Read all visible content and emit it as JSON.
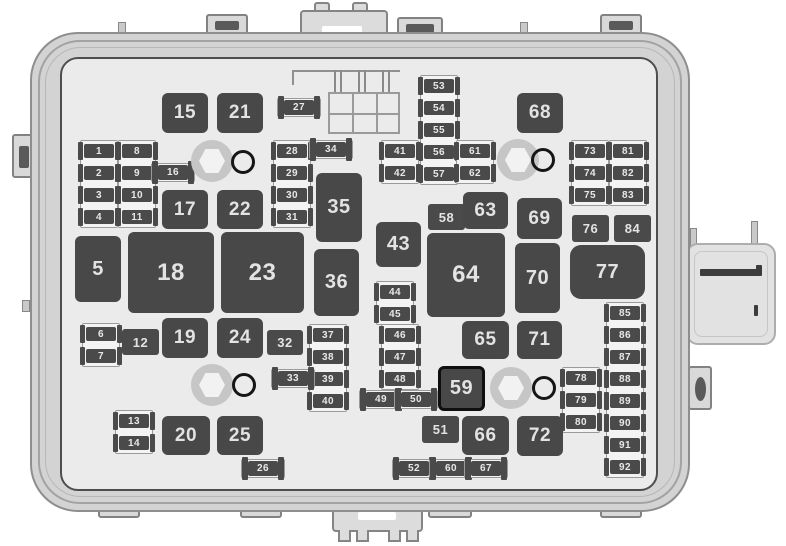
{
  "diagram": {
    "type": "fuse-box",
    "description": "Engine compartment fuse block diagram with numbered fuses and relays 1-92",
    "colors": {
      "case": "#d3d3d3",
      "panel": "#ebebeb",
      "relay_fill": "#484848",
      "fuse_fill": "#4a4a4a",
      "number_color": "#e3e3e3",
      "outline": "#4e4e4e"
    },
    "relays": [
      {
        "label": "5",
        "x": 75,
        "y": 236,
        "w": 46,
        "h": 66,
        "fs": 20
      },
      {
        "label": "15",
        "x": 162,
        "y": 93,
        "w": 46,
        "h": 40,
        "fs": 19
      },
      {
        "label": "21",
        "x": 217,
        "y": 93,
        "w": 46,
        "h": 40,
        "fs": 19
      },
      {
        "label": "17",
        "x": 162,
        "y": 190,
        "w": 46,
        "h": 39,
        "fs": 19
      },
      {
        "label": "22",
        "x": 217,
        "y": 190,
        "w": 46,
        "h": 39,
        "fs": 19
      },
      {
        "label": "18",
        "x": 128,
        "y": 232,
        "w": 86,
        "h": 81,
        "fs": 24
      },
      {
        "label": "23",
        "x": 221,
        "y": 232,
        "w": 83,
        "h": 81,
        "fs": 24
      },
      {
        "label": "19",
        "x": 162,
        "y": 318,
        "w": 46,
        "h": 40,
        "fs": 19
      },
      {
        "label": "24",
        "x": 217,
        "y": 318,
        "w": 46,
        "h": 40,
        "fs": 19
      },
      {
        "label": "20",
        "x": 162,
        "y": 416,
        "w": 48,
        "h": 39,
        "fs": 19
      },
      {
        "label": "25",
        "x": 217,
        "y": 416,
        "w": 46,
        "h": 39,
        "fs": 19
      },
      {
        "label": "35",
        "x": 316,
        "y": 173,
        "w": 46,
        "h": 69,
        "fs": 20
      },
      {
        "label": "36",
        "x": 314,
        "y": 249,
        "w": 45,
        "h": 67,
        "fs": 20
      },
      {
        "label": "43",
        "x": 376,
        "y": 222,
        "w": 45,
        "h": 45,
        "fs": 20
      },
      {
        "label": "59",
        "x": 438,
        "y": 366,
        "w": 47,
        "h": 45,
        "fs": 20,
        "black": true
      },
      {
        "label": "63",
        "x": 463,
        "y": 192,
        "w": 45,
        "h": 37,
        "fs": 19
      },
      {
        "label": "64",
        "x": 427,
        "y": 233,
        "w": 78,
        "h": 84,
        "fs": 24
      },
      {
        "label": "65",
        "x": 462,
        "y": 321,
        "w": 47,
        "h": 38,
        "fs": 19
      },
      {
        "label": "66",
        "x": 462,
        "y": 416,
        "w": 47,
        "h": 39,
        "fs": 19
      },
      {
        "label": "68",
        "x": 517,
        "y": 93,
        "w": 46,
        "h": 40,
        "fs": 19
      },
      {
        "label": "69",
        "x": 517,
        "y": 198,
        "w": 45,
        "h": 41,
        "fs": 19
      },
      {
        "label": "70",
        "x": 515,
        "y": 243,
        "w": 45,
        "h": 70,
        "fs": 20
      },
      {
        "label": "71",
        "x": 517,
        "y": 321,
        "w": 45,
        "h": 38,
        "fs": 19
      },
      {
        "label": "72",
        "x": 517,
        "y": 416,
        "w": 46,
        "h": 40,
        "fs": 19
      },
      {
        "label": "77",
        "x": 570,
        "y": 245,
        "w": 75,
        "h": 54,
        "fs": 20,
        "rounded": true
      }
    ],
    "squares": [
      {
        "label": "12",
        "x": 122,
        "y": 329,
        "w": 37,
        "h": 26
      },
      {
        "label": "32",
        "x": 267,
        "y": 330,
        "w": 36,
        "h": 25
      },
      {
        "label": "51",
        "x": 422,
        "y": 416,
        "w": 37,
        "h": 27
      },
      {
        "label": "58",
        "x": 428,
        "y": 204,
        "w": 37,
        "h": 26
      },
      {
        "label": "76",
        "x": 572,
        "y": 215,
        "w": 37,
        "h": 27
      },
      {
        "label": "84",
        "x": 614,
        "y": 215,
        "w": 37,
        "h": 27
      }
    ],
    "h_fuses": [
      {
        "label": "16",
        "x": 158,
        "y": 165
      },
      {
        "label": "27",
        "x": 284,
        "y": 100
      },
      {
        "label": "34",
        "x": 316,
        "y": 142
      },
      {
        "label": "33",
        "x": 278,
        "y": 371
      },
      {
        "label": "49",
        "x": 366,
        "y": 392
      },
      {
        "label": "50",
        "x": 401,
        "y": 392
      },
      {
        "label": "26",
        "x": 248,
        "y": 461
      },
      {
        "label": "52",
        "x": 399,
        "y": 461
      },
      {
        "label": "60",
        "x": 436,
        "y": 461
      },
      {
        "label": "67",
        "x": 471,
        "y": 461
      }
    ],
    "v_columns": [
      {
        "x": 84,
        "y": 144,
        "labels": [
          "1",
          "2",
          "3",
          "4"
        ]
      },
      {
        "x": 122,
        "y": 144,
        "labels": [
          "8",
          "9",
          "10",
          "11"
        ]
      },
      {
        "x": 277,
        "y": 144,
        "labels": [
          "28",
          "29",
          "30",
          "31"
        ]
      },
      {
        "x": 424,
        "y": 79,
        "labels": [
          "53",
          "54",
          "55",
          "56",
          "57"
        ]
      },
      {
        "x": 385,
        "y": 144,
        "labels": [
          "41",
          "42"
        ]
      },
      {
        "x": 460,
        "y": 144,
        "labels": [
          "61",
          "62"
        ]
      },
      {
        "x": 575,
        "y": 144,
        "labels": [
          "73",
          "74",
          "75"
        ]
      },
      {
        "x": 613,
        "y": 144,
        "labels": [
          "81",
          "82",
          "83"
        ]
      },
      {
        "x": 86,
        "y": 327,
        "labels": [
          "6",
          "7"
        ]
      },
      {
        "x": 313,
        "y": 328,
        "labels": [
          "37",
          "38",
          "39",
          "40"
        ]
      },
      {
        "x": 380,
        "y": 285,
        "labels": [
          "44",
          "45"
        ]
      },
      {
        "x": 385,
        "y": 328,
        "labels": [
          "46",
          "47",
          "48"
        ]
      },
      {
        "x": 566,
        "y": 371,
        "labels": [
          "78",
          "79",
          "80"
        ]
      },
      {
        "x": 610,
        "y": 306,
        "labels": [
          "85",
          "86",
          "87",
          "88",
          "89",
          "90",
          "91",
          "92"
        ]
      },
      {
        "x": 119,
        "y": 414,
        "labels": [
          "13",
          "14"
        ]
      }
    ],
    "bolts": [
      {
        "x": 191,
        "y": 140
      },
      {
        "x": 497,
        "y": 139
      },
      {
        "x": 191,
        "y": 364
      },
      {
        "x": 490,
        "y": 367
      }
    ],
    "rings": [
      {
        "x": 231,
        "y": 150
      },
      {
        "x": 531,
        "y": 148
      },
      {
        "x": 232,
        "y": 373
      },
      {
        "x": 532,
        "y": 376
      }
    ]
  }
}
